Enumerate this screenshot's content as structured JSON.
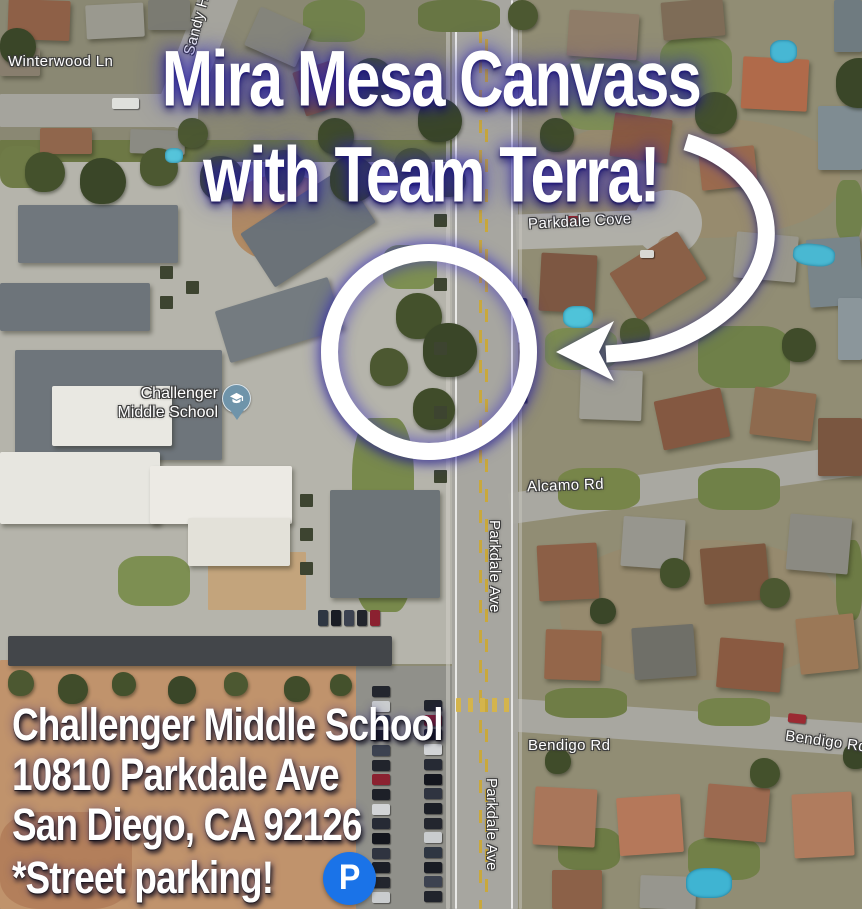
{
  "title": {
    "line1": "Mira Mesa Canvass",
    "line2": "with Team Terra!"
  },
  "address": {
    "line1": "Challenger Middle School",
    "line2": "10810 Parkdale Ave",
    "line3": "San Diego, CA 92126",
    "line4": "*Street parking!"
  },
  "parking_badge": {
    "letter": "P"
  },
  "school_marker": {
    "line1": "Challenger",
    "line2": "Middle School",
    "icon": "graduation-cap"
  },
  "map_labels": {
    "winterwood_ln": "Winterwood Ln",
    "sandy_st": "Sandy Ho",
    "parkdale_cove": "Parkdale Cove",
    "alcamo_rd": "Alcamo Rd",
    "parkdale_ave_upper": "Parkdale Ave",
    "parkdale_ave_lower": "Parkdale Ave",
    "bendigo_rd_left": "Bendigo Rd",
    "bendigo_rd_right": "Bendigo Rd"
  },
  "annotations": {
    "circle": "meeting-spot-circle",
    "arrow": "curved-arrow"
  },
  "colors": {
    "headline_text": "#ffffff",
    "glow_blue": "#2b21c3",
    "parking_blue": "#1a73e8",
    "pin_blue_gray": "#6f94aa",
    "label_outline": "#3c3c3c"
  }
}
